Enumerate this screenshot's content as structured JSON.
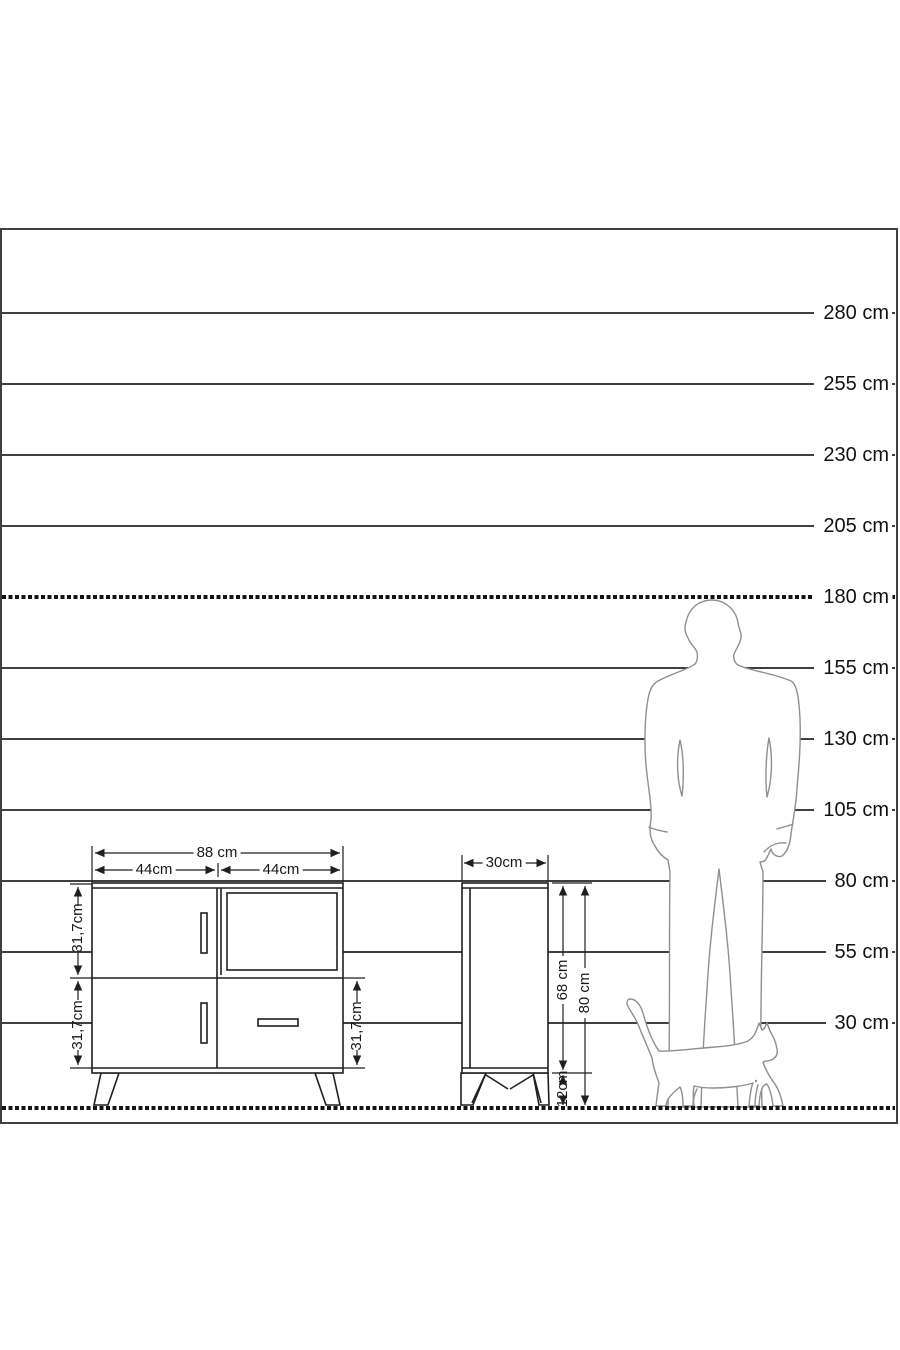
{
  "meta": {
    "type": "furniture-dimension-diagram",
    "unit": "cm"
  },
  "scale": {
    "tick_labels": [
      "280 cm",
      "255 cm",
      "230 cm",
      "205 cm",
      "180 cm",
      "155 cm",
      "130 cm",
      "105 cm",
      "80 cm",
      "55 cm",
      "30 cm"
    ],
    "tick_values_cm": [
      280,
      255,
      230,
      205,
      180,
      155,
      130,
      105,
      80,
      55,
      30
    ],
    "dashed_reference_cm": 180,
    "ground_cm": 0
  },
  "front_view": {
    "overall_width": "88 cm",
    "left_section_width": "44cm",
    "right_section_width": "44cm",
    "upper_section_height": "31,7cm",
    "lower_section_height_left": "31,7cm",
    "lower_section_height_right": "31,7cm"
  },
  "side_view": {
    "depth": "30cm",
    "carcass_height": "68 cm",
    "total_height": "80 cm",
    "leg_height": "12cm"
  },
  "figures": {
    "man": "standing-man-silhouette",
    "cat": "walking-cat-silhouette"
  },
  "colors": {
    "background": "#ffffff",
    "frame": "#3f3f3f",
    "scale_line": "#3f3f3f",
    "dashed_line": "#141414",
    "drawing_line": "#1f1f1f",
    "figure_outline": "#8f8f8f",
    "text": "#111111"
  }
}
